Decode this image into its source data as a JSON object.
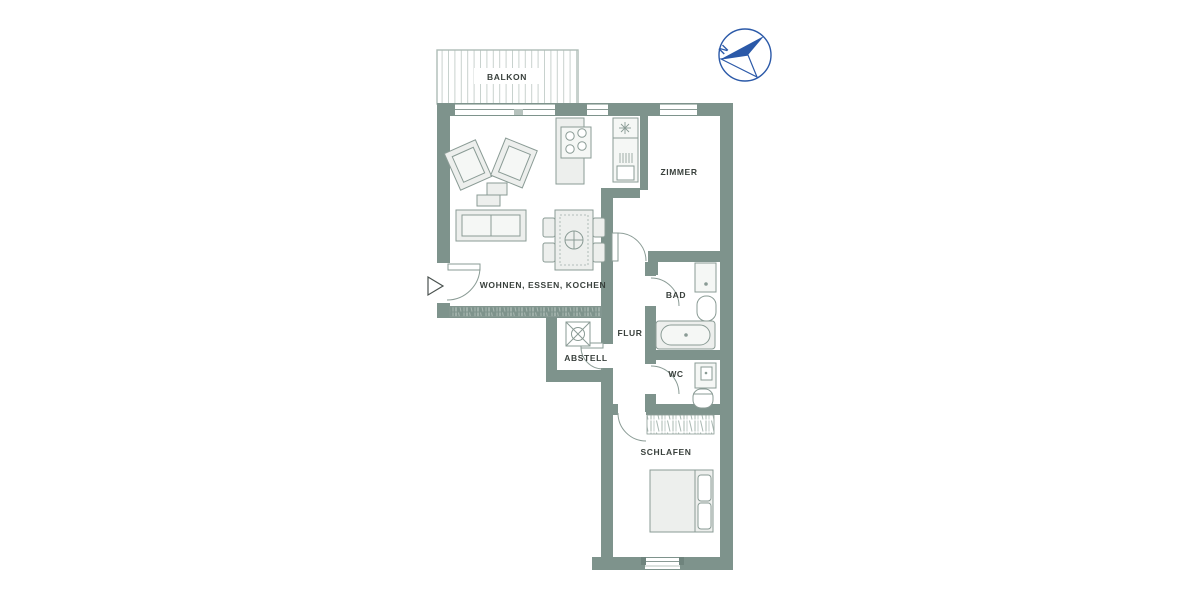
{
  "plan": {
    "type": "apartment-floor-plan",
    "rooms": {
      "balkon": {
        "label": "BALKON"
      },
      "zimmer": {
        "label": "ZIMMER"
      },
      "wohnen": {
        "label": "WOHNEN, ESSEN, KOCHEN"
      },
      "bad": {
        "label": "BAD"
      },
      "flur": {
        "label": "FLUR"
      },
      "abstell": {
        "label": "ABSTELL"
      },
      "wc": {
        "label": "WC"
      },
      "schlafen": {
        "label": "SCHLAFEN"
      }
    },
    "compass": {
      "north_label": "N"
    }
  },
  "colors": {
    "wall": "#7E938C",
    "outline": "#8A9B95",
    "furniture_fill": "#EDEFED",
    "furniture_light": "#F5F7F5",
    "text": "#39403C",
    "compass_blue": "#2B59A8",
    "balcony_stripe": "#C8D1CD",
    "hatch": "#A9B8B2",
    "background": "#FFFFFF"
  }
}
